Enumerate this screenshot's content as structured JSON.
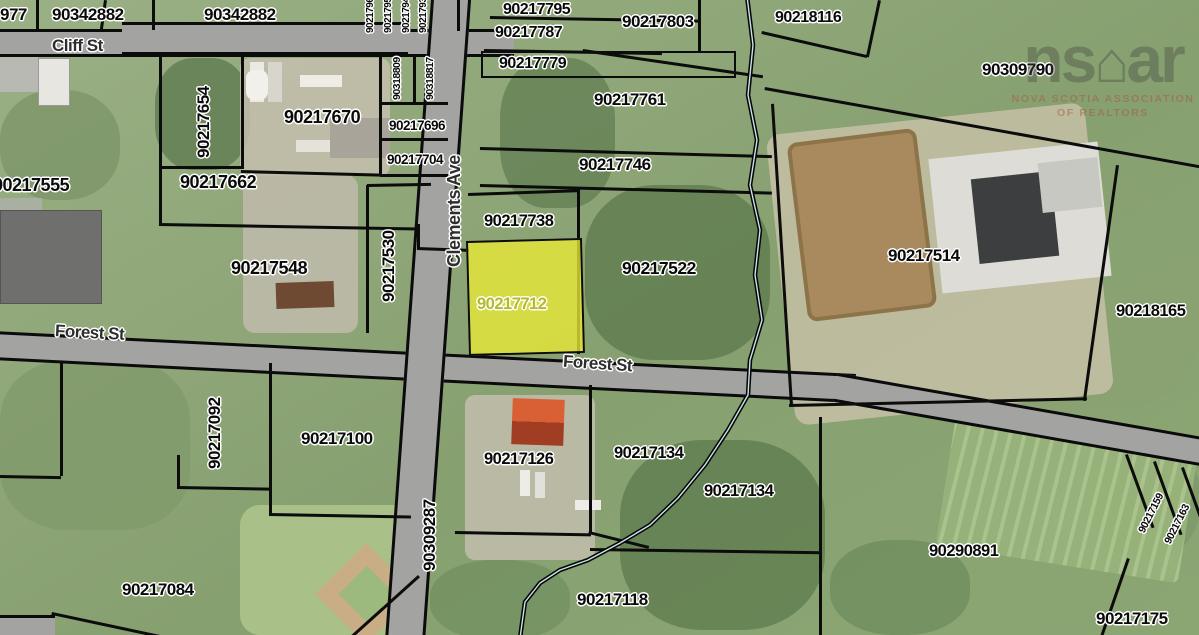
{
  "streets": {
    "cliff": "Cliff St",
    "forest_west": "Forest St",
    "forest_center": "Forest St",
    "clements": "Clements Ave"
  },
  "highlighted_parcel": {
    "id": "90217712",
    "fill": "#ebeb3c",
    "label_color": "#b5b92c"
  },
  "parcels": {
    "p977": "977",
    "p90342882_1": "90342882",
    "p90342882_2": "90342882",
    "p90217969": "90217969",
    "p90217951": "90217951",
    "p90217944": "90217944",
    "p90217936": "90217936",
    "p90217795": "90217795",
    "p90217787": "90217787",
    "p90217779": "90217779",
    "p90217803": "90217803",
    "p90218116": "90218116",
    "p90309790": "90309790",
    "p90217761": "90217761",
    "p90217746": "90217746",
    "p90217654": "90217654",
    "p90217670": "90217670",
    "p90318809": "90318809",
    "p90318817": "90318817",
    "p90217696": "90217696",
    "p90217704": "90217704",
    "p90217662": "90217662",
    "p90217555": "90217555",
    "p90217530": "90217530",
    "p90217548": "90217548",
    "p90217738": "90217738",
    "p90217712": "90217712",
    "p90217522": "90217522",
    "p90217514": "90217514",
    "p90218165": "90218165",
    "p90217092": "90217092",
    "p90217100": "90217100",
    "p90309287": "90309287",
    "p90217126": "90217126",
    "p90217134_1": "90217134",
    "p90217134_2": "90217134",
    "p90217118": "90217118",
    "p90217084": "90217084",
    "p90290891": "90290891",
    "p90217159": "90217159",
    "p90217163": "90217163",
    "p90217175": "90217175"
  },
  "watermark": {
    "logo_left": "ns",
    "logo_house": "⌂",
    "logo_right": "ar",
    "subtitle_line1": "NOVA SCOTIA ASSOCIATION",
    "subtitle_line2": "OF REALTORS"
  }
}
